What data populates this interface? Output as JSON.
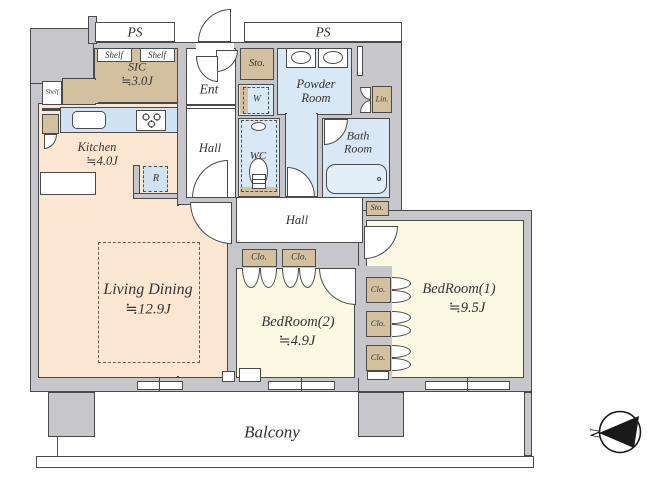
{
  "labels": {
    "ps_left": "PS",
    "ps_right": "PS",
    "shelf_left": "Shelf",
    "shelf_a": "Shelf",
    "shelf_b": "Shelf",
    "sic_name": "SIC",
    "sic_size": "≒3.0J",
    "ent": "Ent",
    "sto_top": "Sto.",
    "sto_mid": "Sto.",
    "powder_room": "Powder Room",
    "washer": "W",
    "linen": "Lin.",
    "hall_top": "Hall",
    "hall_mid": "Hall",
    "wc": "WC",
    "bath_room": "Bath Room",
    "kitchen_name": "Kitchen",
    "kitchen_size": "≒4.0J",
    "fridge": "R",
    "living_name": "Living Dining",
    "living_size": "≒12.9J",
    "bed2_name": "BedRoom(2)",
    "bed2_size": "≒4.9J",
    "bed1_name": "BedRoom(1)",
    "bed1_size": "≒9.5J",
    "clo_a": "Clo.",
    "clo_b": "Clo.",
    "clo_1": "Clo.",
    "clo_2": "Clo.",
    "clo_3": "Clo.",
    "balcony": "Balcony",
    "compass_north": "N"
  },
  "colors": {
    "wall_fill": "#c6c6cb",
    "wall_line": "#4a4a4a",
    "floor_warm": "#fbe7d2",
    "floor_yellow": "#fbf9e4",
    "floor_blue": "#d8e9f5",
    "closet_tan": "#d2c09e",
    "fixture_blue": "#cfe3f2",
    "tub_blue": "#e2eef8",
    "text_color": "#343434",
    "compass_black": "#1a1a1a"
  }
}
